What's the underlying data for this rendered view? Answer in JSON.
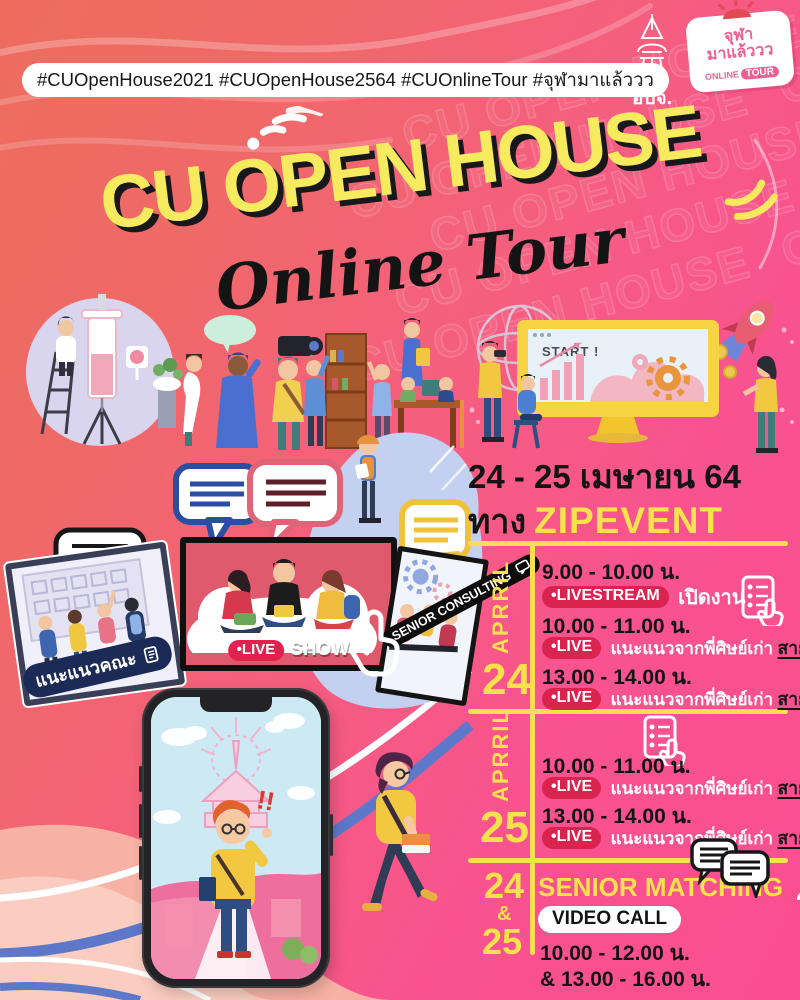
{
  "colors": {
    "bg-coral": "#ED6C5E",
    "bg-pink": "#FA4E90",
    "accent-yellow": "#F8E14C",
    "title-yellow": "#F6EA5E",
    "badge-red": "#DB2350",
    "banner-navy": "#1C2A57",
    "stripe-blue": "#5D77C9",
    "screen-red": "#DF5A6D",
    "cloud-blue": "#C3D0F0",
    "salmon-wave": "#F8B3A6"
  },
  "header": {
    "hashtags": "#CUOpenHouse2021 #CUOpenHouse2564 #CUOnlineTour #จุฬามาแล้ววว",
    "tower_logo_label": "อบจ.",
    "badge_logo": {
      "line1": "จุฬา",
      "line2": "มาแล้ววว",
      "online": "ONLINE",
      "tour": "TOUR"
    }
  },
  "title": {
    "main": "CU OPEN HOUSE",
    "sub": "Online Tour",
    "watermark": "CU OPEN HOUSE"
  },
  "event": {
    "date": "24 - 25 เมษายน 64",
    "channel_prefix": "ทาง",
    "channel_name": "ZIPEVENT"
  },
  "monitor": {
    "screen_text": "START !"
  },
  "screens": {
    "left_banner": "แนะแนวคณะ",
    "live_badge": "•LIVE",
    "live_label": "SHOW",
    "right_banner": "SENIOR CONSULTING"
  },
  "schedule": [
    {
      "month": "APRRIL",
      "day": "24",
      "items": [
        {
          "time": "9.00 - 10.00 น.",
          "badge": "•LIVESTREAM",
          "desc": "เปิดงาน",
          "suffix": ""
        },
        {
          "time": "10.00 - 11.00 น.",
          "badge": "•LIVE",
          "desc": "แนะแนวจากพี่ศิษย์เก่า",
          "suffix": "สายวิทย์"
        },
        {
          "time": "13.00 - 14.00 น.",
          "badge": "•LIVE",
          "desc": "แนะแนวจากพี่ศิษย์เก่า",
          "suffix": "สายศิลป์"
        }
      ]
    },
    {
      "month": "APRRIL",
      "day": "25",
      "items": [
        {
          "time": "10.00 - 11.00 น.",
          "badge": "•LIVE",
          "desc": "แนะแนวจากพี่ศิษย์เก่า",
          "suffix": "สายศิลป์"
        },
        {
          "time": "13.00 - 14.00 น.",
          "badge": "•LIVE",
          "desc": "แนะแนวจากพี่ศิษย์เก่า",
          "suffix": "สายวิทย์"
        }
      ]
    }
  ],
  "matching": {
    "day_top": "24",
    "day_mid": "&",
    "day_bottom": "25",
    "title": "SENIOR MATCHING",
    "badge": "VIDEO CALL",
    "time1": "10.00 - 12.00 น.",
    "time2": "& 13.00 - 16.00 น."
  },
  "phone": {
    "exclaim": "!!"
  }
}
